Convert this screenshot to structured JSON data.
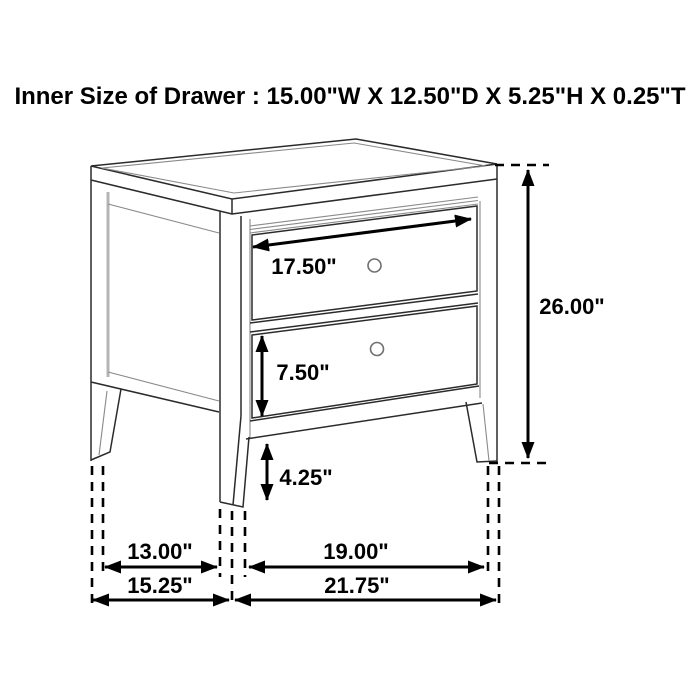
{
  "title": "Inner Size of Drawer : 15.00\"W X 12.50\"D X 5.25\"H X 0.25\"T",
  "product": "two-drawer-nightstand-line-drawing",
  "dimensions": {
    "drawer_inner_width": "17.50\"",
    "bottom_drawer_height": "7.50\"",
    "leg_height": "4.25\"",
    "overall_height": "26.00\"",
    "side_inner_leg_span": "13.00\"",
    "front_inner_leg_span": "19.00\"",
    "overall_depth": "15.25\"",
    "overall_width": "21.75\""
  },
  "colors": {
    "background": "#ffffff",
    "line_art": "#2b2b2b",
    "dimension_lines": "#000000",
    "text": "#000000"
  }
}
